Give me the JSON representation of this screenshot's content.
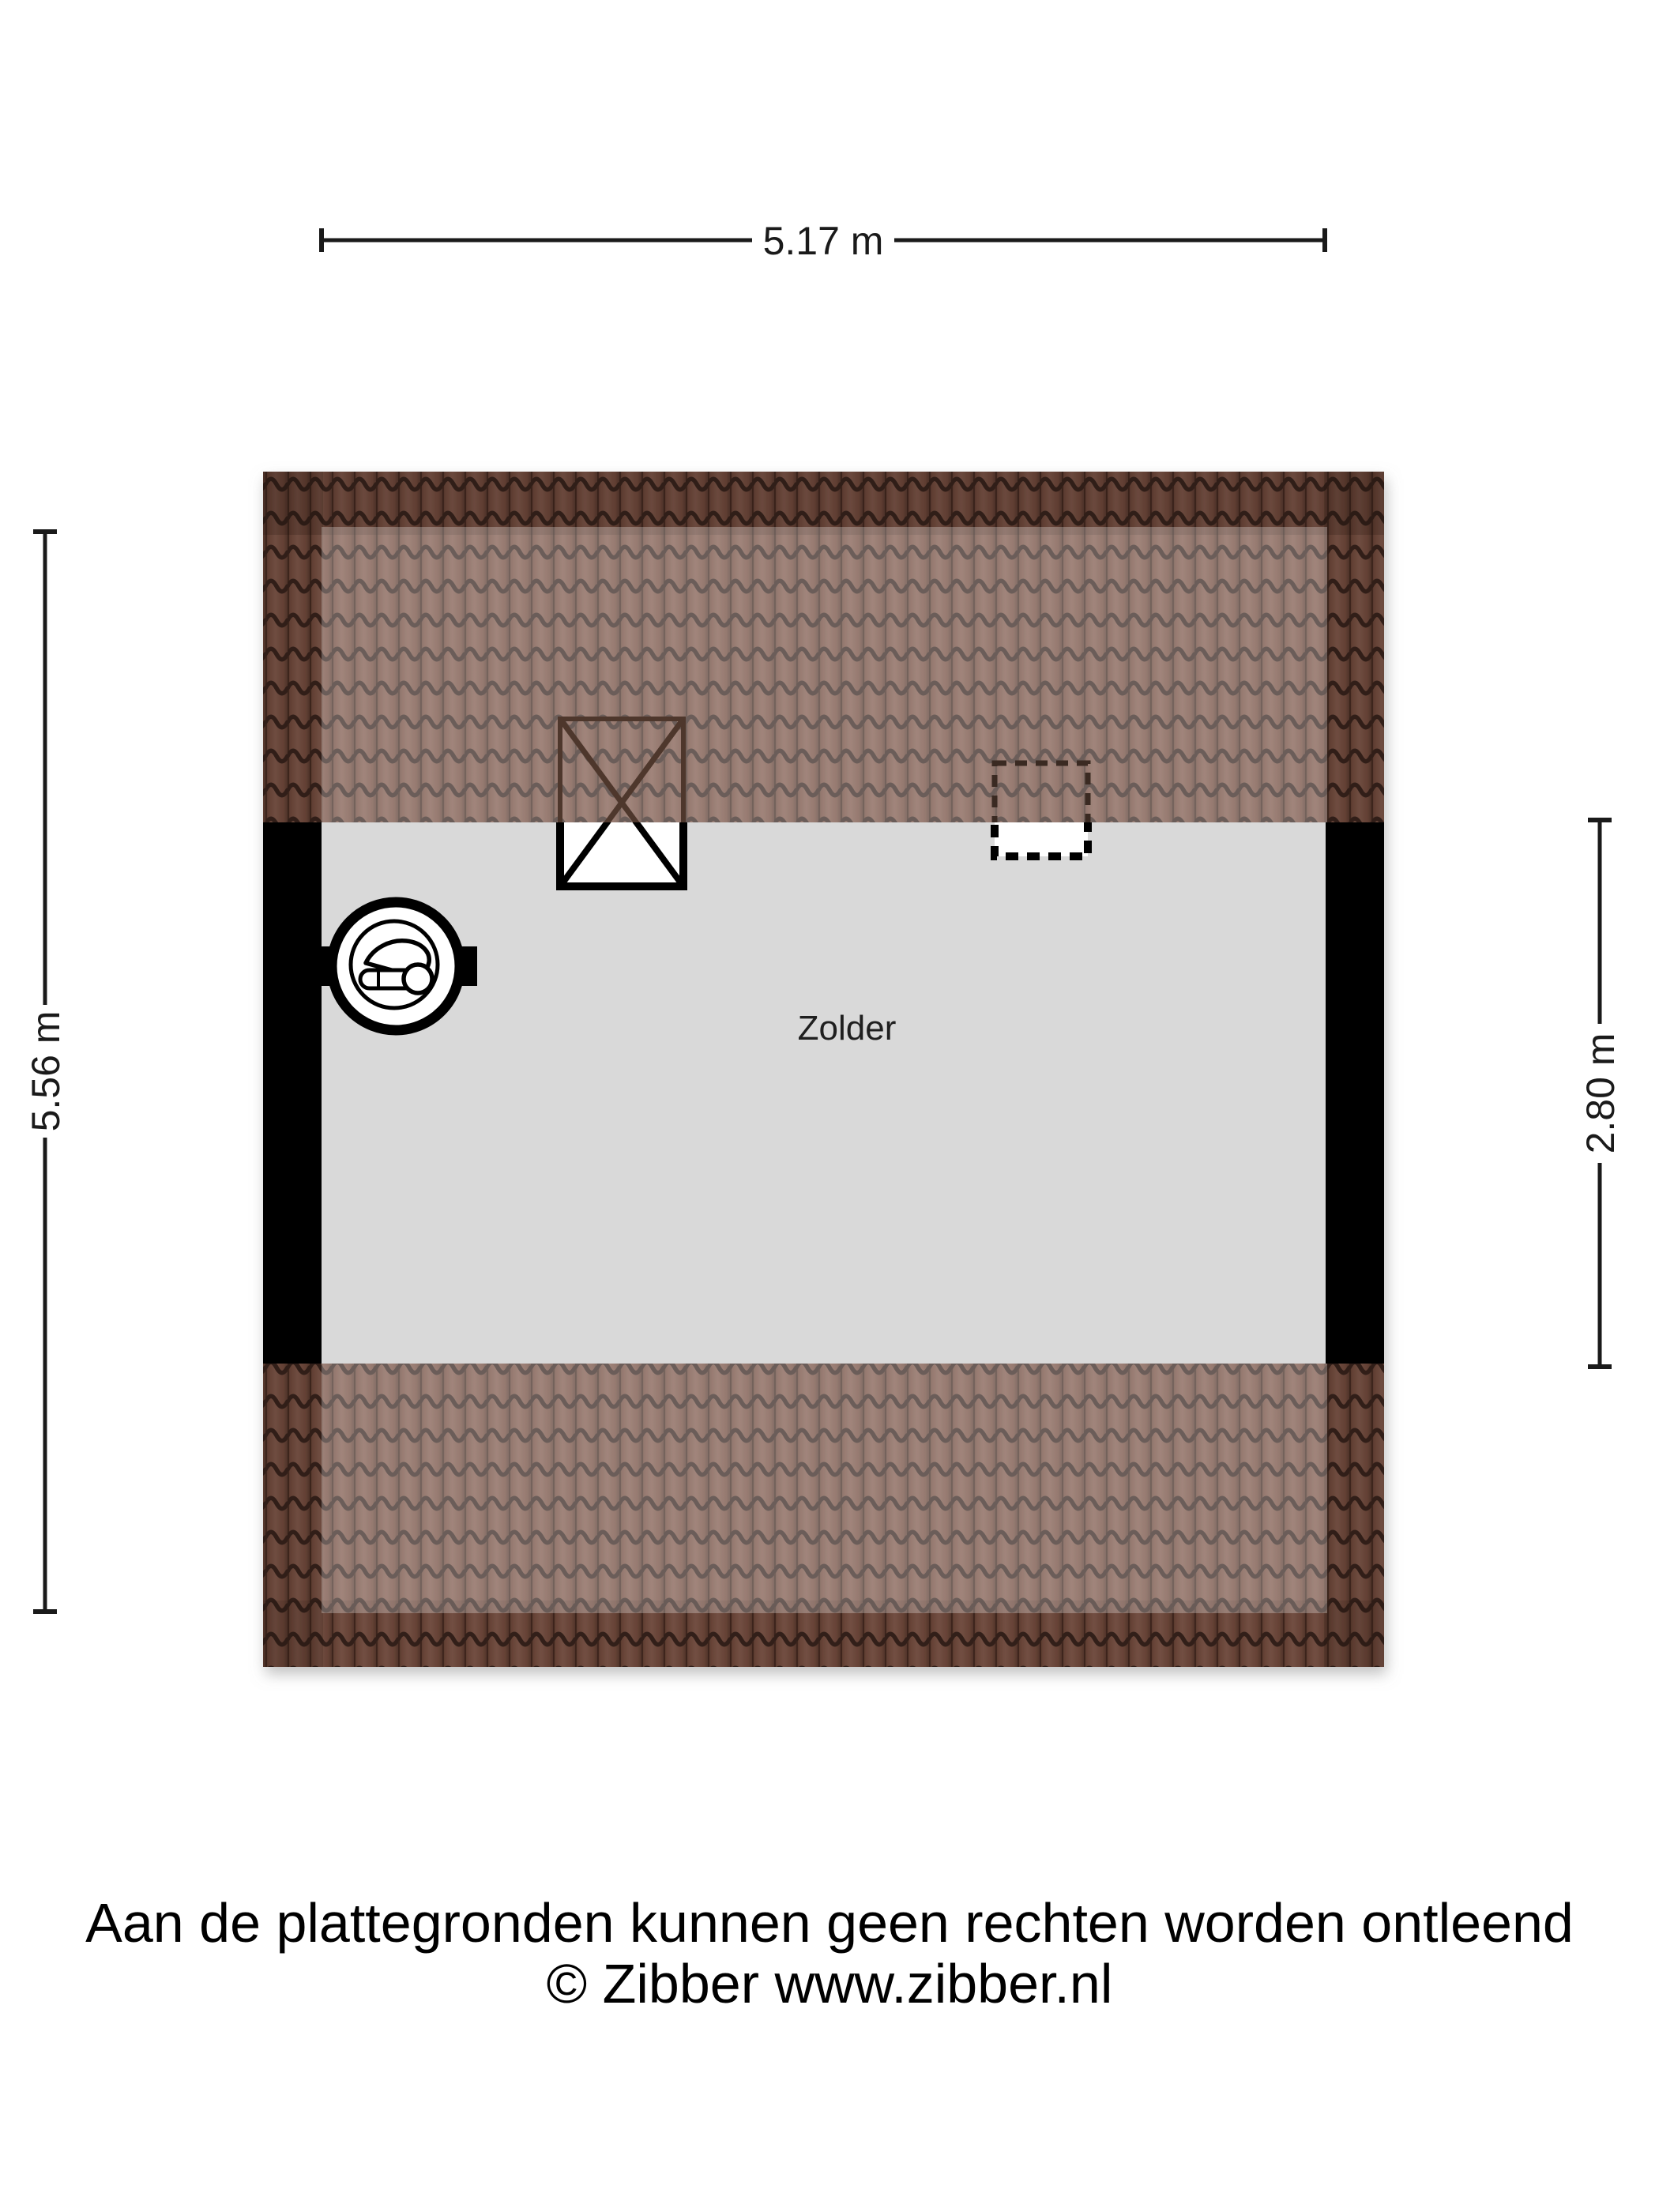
{
  "floor_plan": {
    "room": {
      "label": "Zolder"
    },
    "dimensions": {
      "width_top": "5.17 m",
      "height_left": "5.56 m",
      "height_right": "2.80 m"
    },
    "symbols": {
      "chimney": "crossed-box-flue",
      "skylight": "dashed-roof-window",
      "boiler": "cv-ketel-circle"
    },
    "colors": {
      "roof_tile_base": "#764e40",
      "roof_tile_line": "#35241e",
      "roof_inner_highlight": "rgba(255,255,255,0.27)",
      "floor": "#d9d9d9",
      "wall": "#000000"
    }
  },
  "footer": {
    "line1": "Aan de plattegronden kunnen geen rechten worden ontleend",
    "line2": "© Zibber www.zibber.nl"
  }
}
